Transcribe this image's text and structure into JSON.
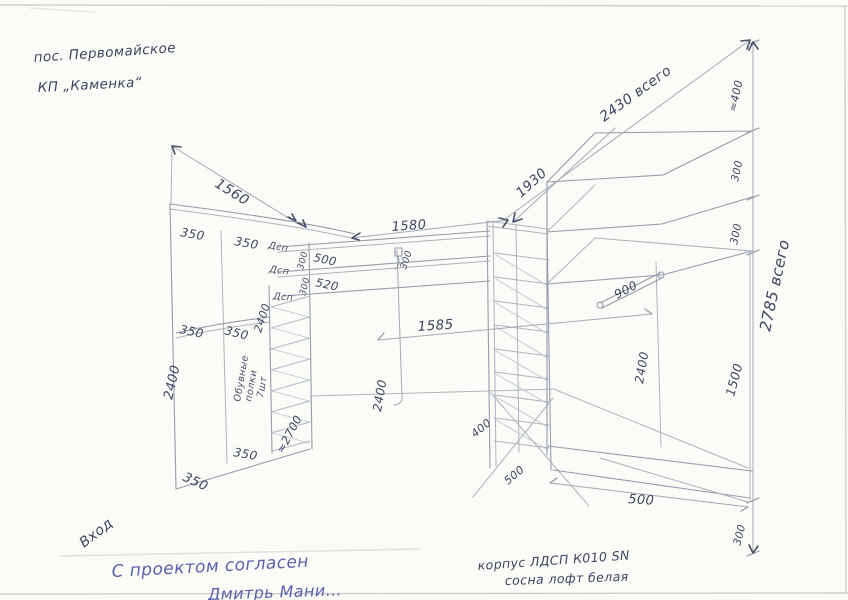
{
  "colors": {
    "paper": "#fbfbf8",
    "pencil_line": "#adb2bc",
    "ink_handwriting": "#3e4562",
    "approval_blue": "#5c61ae",
    "shoe_hatch": "#bcc6d2"
  },
  "doc": {
    "location_line1": "пос. Первомайское",
    "location_line2": "КП „Каменка“",
    "entrance": "Вход",
    "approval_line1": "С проектом согласен",
    "approval_line2": "Дмитрь Мани…",
    "material_line1": "корпус ЛДСП К010 SN",
    "material_line2": "сосна лофт белая",
    "shoe_note_line1": "Обувные",
    "shoe_note_line2": "полки",
    "shoe_note_line3": "7шт",
    "panel_label_1": "Дсп",
    "panel_label_2": "Дсп",
    "panel_label_3": "Дсп"
  },
  "dims": {
    "left_diag": "1560",
    "top_width": "1580",
    "mid_width": "1585",
    "right_diag_inner": "1930",
    "right_diag_total": "2430 всего",
    "right_total_height": "2785 всего",
    "top_350_a": "350",
    "top_350_b": "350",
    "mid_350_a": "350",
    "mid_350_b": "350",
    "bot_350_a": "350",
    "bot_350_b": "350",
    "shelf_500": "500",
    "shelf_520": "520",
    "gap_300_a": "300",
    "gap_300_b": "300",
    "rod_offset_300": "300",
    "height_2400_left": "2400",
    "height_2400_inner": "2400",
    "height_2400_center": "2400",
    "height_2400_right": "2400",
    "height_2700": "≈2700",
    "column_depth_400": "400",
    "column_width_500": "500",
    "base_depth_500": "500",
    "plinth_300": "300",
    "rod_900": "900",
    "right_1500": "1500",
    "top_depth_400": "≈400",
    "right_300_a": "300",
    "right_300_b": "300"
  }
}
